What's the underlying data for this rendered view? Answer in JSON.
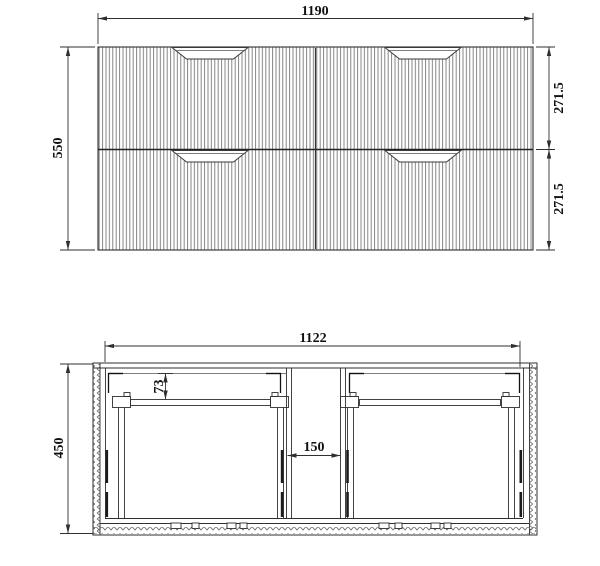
{
  "front_view": {
    "overall_width": "1190",
    "overall_height": "550",
    "top_drawer_height": "271.5",
    "bottom_drawer_height": "271.5"
  },
  "plan_view": {
    "internal_width": "1122",
    "overall_depth": "450",
    "runner_setback": "73",
    "center_gap": "150"
  },
  "colors": {
    "line": "#2f2f2f",
    "flute_line": "#787878",
    "background": "#ffffff"
  }
}
